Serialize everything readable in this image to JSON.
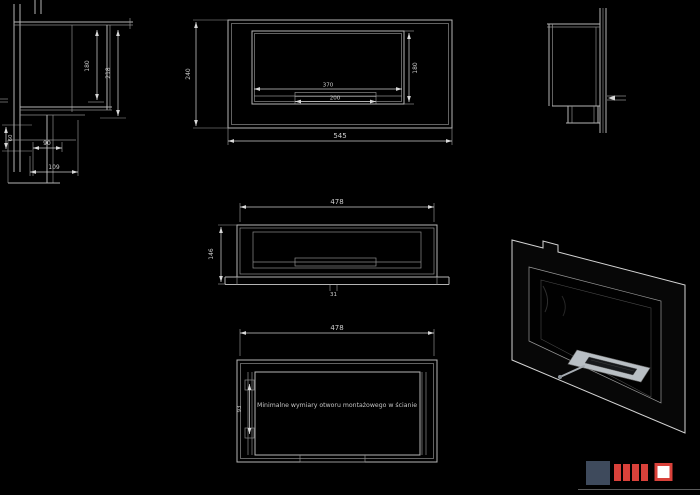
{
  "colors": {
    "background": "#000000",
    "line": "#b4b4b4",
    "dim_text": "#cdcdcd",
    "body_black": "#070707",
    "burner": "#b9bfc4",
    "logo_navy": "#3e4a5c",
    "logo_red": "#d9413a"
  },
  "views": {
    "side_section": {
      "height_inner": "180",
      "height_outer": "218",
      "offset": "60",
      "depth_inner": "90",
      "depth_outer": "109"
    },
    "front": {
      "width_overall": "545",
      "width_opening": "370",
      "width_burner": "200",
      "height_overall": "240",
      "height_opening": "180"
    },
    "plan": {
      "width": "478",
      "depth": "146",
      "lip": "31"
    },
    "casing": {
      "width": "478",
      "bracket": "93",
      "note": "Minimalne wymiary otworu montażowego w ścianie"
    }
  }
}
